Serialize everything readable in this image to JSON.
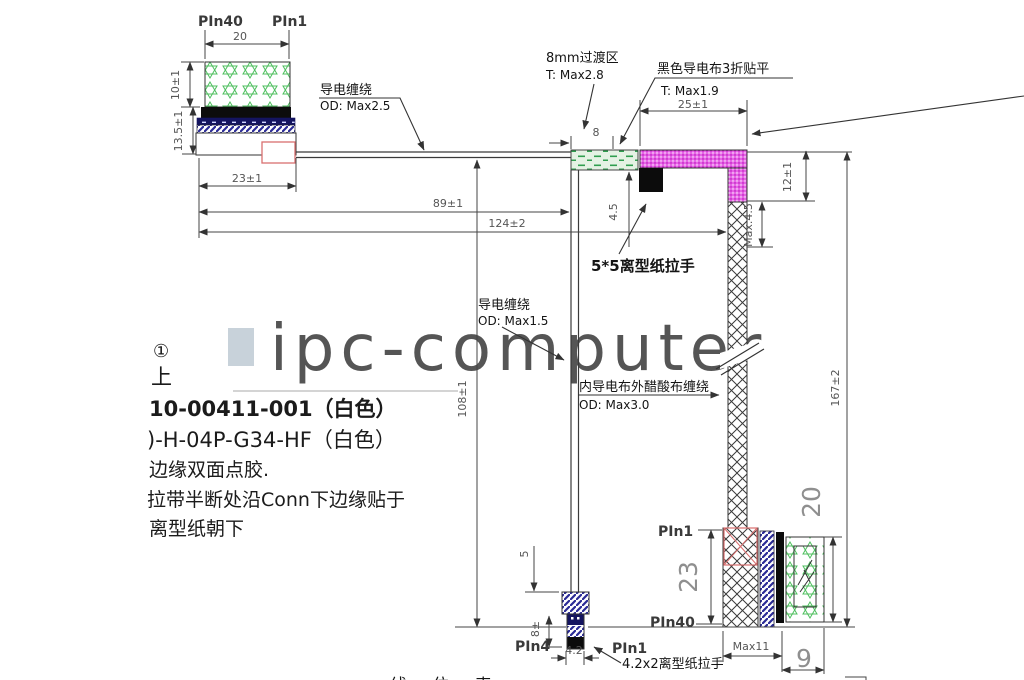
{
  "watermark": {
    "text": "ipc-computer"
  },
  "colors": {
    "magenta": "#e564e5",
    "green_pattern": "#4fbf5f",
    "green_strip_bg": "#e4f2e4",
    "navy": "#141460",
    "hatch_blue": "#2a2a96",
    "red_marker": "#d96f6f",
    "watermark": "#c8d2da",
    "line": "#3a3a3a"
  },
  "connector_top_left": {
    "pin_label_start": "PIn40",
    "pin_label_end": "PIn1",
    "width_dim": "20",
    "height_dim": "10±1",
    "stack_height_dim": "13.5±1",
    "body_width_dim": "23±1"
  },
  "annotations": {
    "wrap_top": {
      "line1": "导电缠绕",
      "line2": "OD: Max2.5"
    },
    "transition": {
      "line1": "8mm过渡区",
      "line2": "T: Max2.8"
    },
    "black_cloth": {
      "line1": "黑色导电布3折贴平",
      "line2": "T: Max1.9"
    },
    "pull_tab_5x5": "5*5离型纸拉手",
    "wrap_mid": {
      "line1": "导电缠绕",
      "line2": "OD: Max1.5"
    },
    "acetate_wrap": {
      "line1": "内导电布外醋酸布缠绕",
      "line2": "OD: Max3.0"
    },
    "pull_tab_bottom": "4.2x2离型纸拉手"
  },
  "dims": {
    "seg8": "8",
    "w25": "25±1",
    "h12": "12±1",
    "max45": "Max.4.5",
    "h45": "4.5",
    "len89": "89±1",
    "len124": "124±2",
    "len108": "108±1",
    "len167": "167±2",
    "gap5": "5",
    "tail8": "8±",
    "w42": "4.2",
    "right_h23": "23",
    "right_w20": "20",
    "max11": "Max11",
    "w9": "9"
  },
  "connector_bottom": {
    "pin_left": "PIn4",
    "pin_right": "PIn1"
  },
  "connector_right": {
    "pin_top": "PIn1",
    "pin_bottom": "PIn40"
  },
  "notes": {
    "marker": "①",
    "line_up": "上",
    "line1": "10-00411-001（白色）",
    "line2": ")-H-04P-G34-HF（白色）",
    "line3": "边缘双面点胶.",
    "line4": "拉带半断处沿Conn下边缘贴于",
    "line5": "离型纸朝下"
  },
  "table_title": "线 位 表"
}
